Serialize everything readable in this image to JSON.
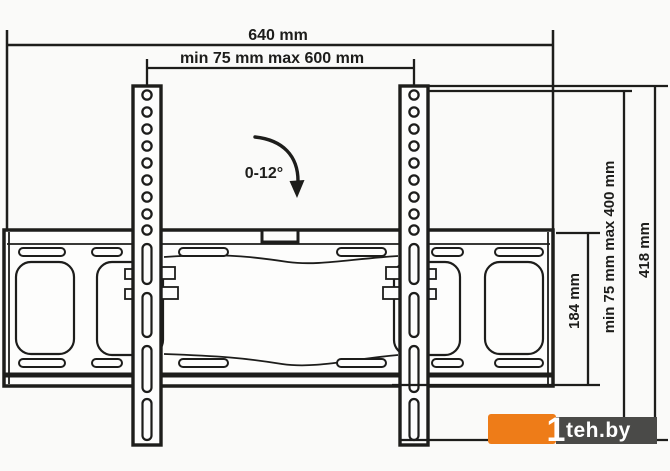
{
  "page": {
    "background": "#fafaf9",
    "line_color": "#1d1d1b"
  },
  "dimensions": {
    "total_width_label": "640 mm",
    "vesa_width_label": "min 75 mm max 600 mm",
    "tilt_angle_label": "0-12°",
    "plate_height_label": "184 mm",
    "vesa_height_label": "min 75 mm max 400 mm",
    "bracket_height_label": "418 mm"
  },
  "watermark": {
    "digit": "1",
    "site": "teh.by",
    "orange_color": "#ee7c18",
    "gray_color": "#4a4a48"
  }
}
